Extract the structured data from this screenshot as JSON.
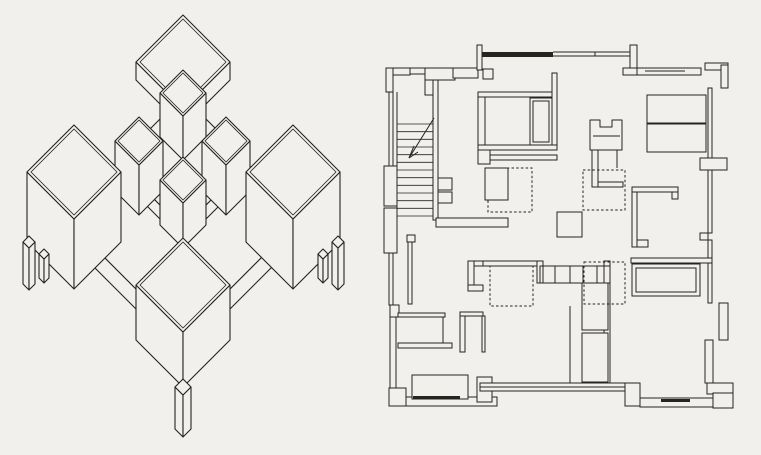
{
  "page": {
    "width": 761,
    "height": 455,
    "colors": {
      "paper": "#f1f0ed",
      "ink": "#26241f"
    }
  },
  "axonometric": {
    "label": "axonometric-projection-of-pavilion-scheme",
    "stroke_width": 1.1,
    "cubes": [
      {
        "name": "lower-platform",
        "x": 183,
        "y": 220,
        "w": 116,
        "h": 20
      },
      {
        "name": "top-pavilion-roof",
        "x": 183,
        "y": 62,
        "w": 47,
        "h": 18,
        "inset": 4
      },
      {
        "name": "upper-platform",
        "x": 183,
        "y": 162,
        "w": 66,
        "h": 14
      },
      {
        "name": "north-tower",
        "x": 183,
        "y": 93,
        "w": 23,
        "h": 44,
        "inset": 3
      },
      {
        "name": "west-tower",
        "x": 139,
        "y": 141,
        "w": 24,
        "h": 50,
        "inset": 3
      },
      {
        "name": "east-tower",
        "x": 226,
        "y": 141,
        "w": 24,
        "h": 50,
        "inset": 3
      },
      {
        "name": "center-tower",
        "x": 183,
        "y": 180,
        "w": 23,
        "h": 45,
        "inset": 3
      },
      {
        "name": "west-pavilion",
        "x": 74,
        "y": 172,
        "w": 47,
        "h": 70,
        "inset": 4
      },
      {
        "name": "east-pavilion",
        "x": 293,
        "y": 172,
        "w": 47,
        "h": 70,
        "inset": 4
      },
      {
        "name": "south-pavilion",
        "x": 183,
        "y": 285,
        "w": 47,
        "h": 55,
        "inset": 4
      },
      {
        "name": "leg",
        "x": 29,
        "y": 242,
        "w": 6,
        "h": 42
      },
      {
        "name": "leg",
        "x": 44,
        "y": 254,
        "w": 5,
        "h": 24
      },
      {
        "name": "leg",
        "x": 338,
        "y": 242,
        "w": 6,
        "h": 42
      },
      {
        "name": "leg",
        "x": 323,
        "y": 254,
        "w": 5,
        "h": 24
      },
      {
        "name": "leg",
        "x": 183,
        "y": 387,
        "w": 8,
        "h": 42
      }
    ]
  },
  "floor_plan": {
    "label": "floor-plan",
    "stroke_width": 1,
    "dash": "2.5 2.2",
    "groups": [
      {
        "name": "outer-walls",
        "items": [
          [
            "r",
            386,
            68,
            24,
            7
          ],
          [
            "r",
            386,
            68,
            7,
            24
          ],
          [
            "r",
            389,
            92,
            4,
            76
          ],
          [
            "r",
            384,
            166,
            13,
            40
          ],
          [
            "r",
            384,
            208,
            13,
            45
          ],
          [
            "r",
            389,
            253,
            4,
            52
          ],
          [
            "r",
            390,
            305,
            9,
            12
          ],
          [
            "r",
            390,
            317,
            6,
            72
          ],
          [
            "r",
            389,
            388,
            17,
            18
          ],
          [
            "r",
            406,
            397,
            91,
            9
          ],
          [
            "r",
            477,
            377,
            15,
            25
          ],
          [
            "r",
            480,
            383,
            157,
            8
          ],
          [
            "l",
            480,
            387,
            637,
            387
          ],
          [
            "r",
            625,
            383,
            15,
            23
          ],
          [
            "r",
            640,
            398,
            93,
            9
          ],
          [
            "f",
            661,
            399,
            29,
            3
          ],
          [
            "r",
            707,
            383,
            26,
            11
          ],
          [
            "r",
            713,
            393,
            20,
            15
          ],
          [
            "r",
            705,
            63,
            23,
            7
          ],
          [
            "r",
            721,
            65,
            7,
            23
          ],
          [
            "r",
            708,
            88,
            4,
            70
          ],
          [
            "r",
            700,
            158,
            27,
            12
          ],
          [
            "r",
            708,
            170,
            4,
            63
          ],
          [
            "r",
            700,
            233,
            8,
            7
          ],
          [
            "r",
            708,
            240,
            4,
            63
          ],
          [
            "r",
            719,
            303,
            9,
            37
          ],
          [
            "r",
            705,
            340,
            8,
            43
          ],
          [
            "r",
            410,
            68,
            16,
            6
          ],
          [
            "r",
            425,
            68,
            30,
            12
          ],
          [
            "r",
            453,
            68,
            25,
            10
          ],
          [
            "r",
            483,
            69,
            10,
            10
          ],
          [
            "r",
            477,
            45,
            5,
            25
          ],
          [
            "f",
            482,
            52,
            71,
            5
          ],
          [
            "l",
            553,
            52,
            633,
            52
          ],
          [
            "l",
            553,
            56,
            633,
            56
          ],
          [
            "l",
            595,
            52,
            595,
            56
          ],
          [
            "r",
            630,
            45,
            7,
            25
          ],
          [
            "r",
            623,
            68,
            17,
            7
          ],
          [
            "r",
            637,
            68,
            64,
            7
          ],
          [
            "l",
            645,
            71,
            685,
            71
          ]
        ]
      },
      {
        "name": "stair",
        "items": [
          [
            "l",
            397,
            92,
            397,
            252
          ],
          [
            "r",
            425,
            80,
            13,
            15
          ],
          [
            "r",
            433,
            80,
            5,
            140
          ],
          [
            "hl",
            397,
            433,
            124,
            216,
            13
          ],
          [
            "l",
            409,
            158,
            434,
            118
          ],
          [
            "l",
            409,
            158,
            418,
            152
          ],
          [
            "l",
            409,
            158,
            414,
            146
          ]
        ]
      },
      {
        "name": "interior-walls",
        "items": [
          [
            "r",
            438,
            178,
            14,
            12
          ],
          [
            "r",
            438,
            192,
            14,
            11
          ],
          [
            "r",
            436,
            218,
            72,
            9
          ],
          [
            "r",
            407,
            235,
            8,
            7
          ],
          [
            "r",
            408,
            242,
            4,
            62
          ],
          [
            "r",
            478,
            92,
            7,
            58
          ],
          [
            "r",
            478,
            92,
            79,
            5
          ],
          [
            "r",
            552,
            73,
            5,
            77
          ],
          [
            "r",
            478,
            145,
            79,
            5
          ],
          [
            "r",
            478,
            150,
            12,
            14
          ],
          [
            "r",
            490,
            155,
            67,
            5
          ],
          [
            "r",
            592,
            150,
            6,
            37
          ],
          [
            "r",
            598,
            182,
            25,
            5
          ],
          [
            "l",
            617,
            150,
            617,
            168
          ],
          [
            "r",
            632,
            187,
            46,
            5
          ],
          [
            "r",
            672,
            192,
            6,
            7
          ],
          [
            "r",
            632,
            192,
            5,
            55
          ],
          [
            "r",
            637,
            240,
            11,
            7
          ],
          [
            "r",
            631,
            258,
            81,
            5
          ],
          [
            "r",
            604,
            261,
            6,
            122
          ],
          [
            "r",
            483,
            261,
            57,
            5
          ],
          [
            "r",
            468,
            261,
            15,
            5
          ],
          [
            "r",
            468,
            261,
            6,
            30
          ],
          [
            "r",
            468,
            285,
            15,
            6
          ],
          [
            "r",
            537,
            261,
            6,
            22
          ],
          [
            "r",
            398,
            313,
            47,
            4
          ],
          [
            "l",
            443,
            317,
            443,
            343
          ],
          [
            "r",
            398,
            343,
            54,
            5
          ],
          [
            "r",
            460,
            312,
            23,
            4
          ],
          [
            "r",
            460,
            316,
            5,
            36
          ],
          [
            "r",
            482,
            316,
            3,
            36
          ],
          [
            "l",
            570,
            306,
            570,
            383
          ]
        ]
      },
      {
        "name": "dashed-outlines-under",
        "items": [
          [
            "d",
            488,
            168,
            44,
            44
          ],
          [
            "d",
            490,
            266,
            43,
            40
          ]
        ]
      },
      {
        "name": "furniture",
        "items": [
          [
            "r",
            485,
            168,
            23,
            32
          ],
          [
            "r",
            530,
            98,
            22,
            47
          ],
          [
            "o",
            533,
            101,
            16,
            41
          ],
          [
            "p",
            [
              [
                590,
                150
              ],
              [
                590,
                120
              ],
              [
                600,
                120
              ],
              [
                600,
                127
              ],
              [
                612,
                127
              ],
              [
                612,
                120
              ],
              [
                622,
                120
              ],
              [
                622,
                150
              ]
            ]
          ],
          [
            "l",
            593,
            136,
            620,
            136
          ],
          [
            "r",
            557,
            212,
            25,
            25
          ],
          [
            "r",
            647,
            95,
            59,
            28
          ],
          [
            "r",
            647,
            124,
            59,
            28
          ],
          [
            "r",
            632,
            264,
            68,
            32
          ],
          [
            "o",
            636,
            268,
            60,
            24
          ],
          [
            "r",
            582,
            283,
            26,
            47
          ],
          [
            "r",
            582,
            333,
            26,
            49
          ],
          [
            "o",
            540,
            266,
            70,
            17
          ],
          [
            "l",
            555,
            266,
            555,
            283
          ],
          [
            "l",
            570,
            266,
            570,
            283
          ],
          [
            "l",
            583,
            266,
            583,
            283
          ],
          [
            "l",
            597,
            266,
            597,
            283
          ],
          [
            "r",
            412,
            375,
            56,
            24
          ],
          [
            "f",
            413,
            396,
            47,
            3
          ]
        ]
      },
      {
        "name": "dashed-outlines-over",
        "items": [
          [
            "d",
            583,
            170,
            42,
            40
          ],
          [
            "d",
            584,
            262,
            41,
            42
          ]
        ]
      }
    ]
  }
}
